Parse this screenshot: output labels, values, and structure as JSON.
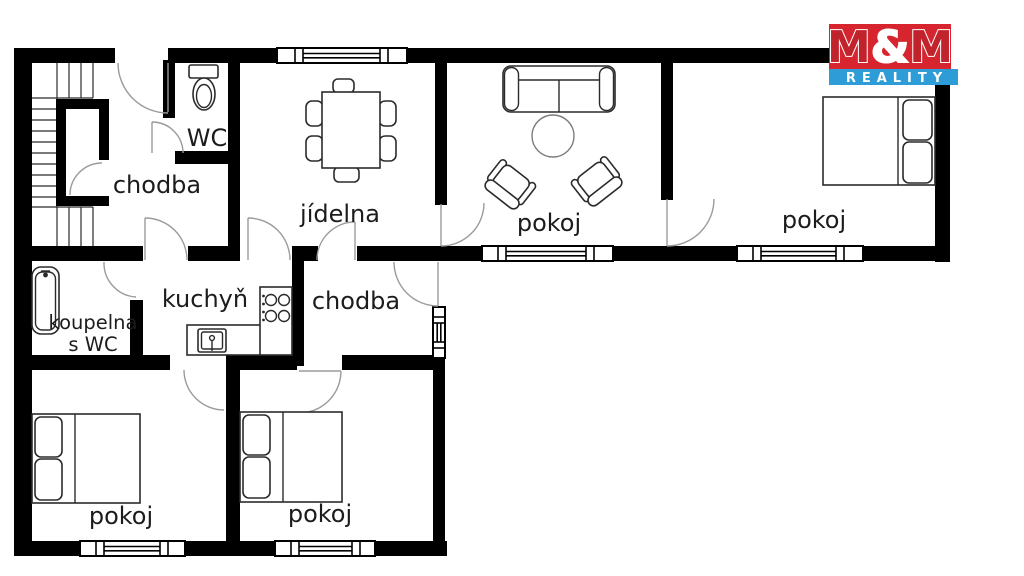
{
  "meta": {
    "background": "#ffffff",
    "wall_color": "#000000",
    "kind": "apartment floor plan"
  },
  "logo": {
    "m1": "M",
    "amp": "&",
    "m2": "M",
    "reality": "REALITY",
    "red_bg": "#d6252e",
    "m_red": "#c0232b",
    "blue_bg": "#2e9cd6",
    "text_white": "#ffffff"
  },
  "rooms": {
    "hall_top": {
      "label": "chodba"
    },
    "wc": {
      "label": "WC"
    },
    "dining": {
      "label": "jídelna"
    },
    "living": {
      "label": "pokoj"
    },
    "bedroom_right": {
      "label": "pokoj"
    },
    "bathroom": {
      "line1": "koupelna",
      "line2": "s WC"
    },
    "kitchen": {
      "label": "kuchyň"
    },
    "hall_middle": {
      "label": "chodba"
    },
    "bedroom_bottom_left": {
      "label": "pokoj"
    },
    "bedroom_bottom_middle": {
      "label": "pokoj"
    }
  }
}
